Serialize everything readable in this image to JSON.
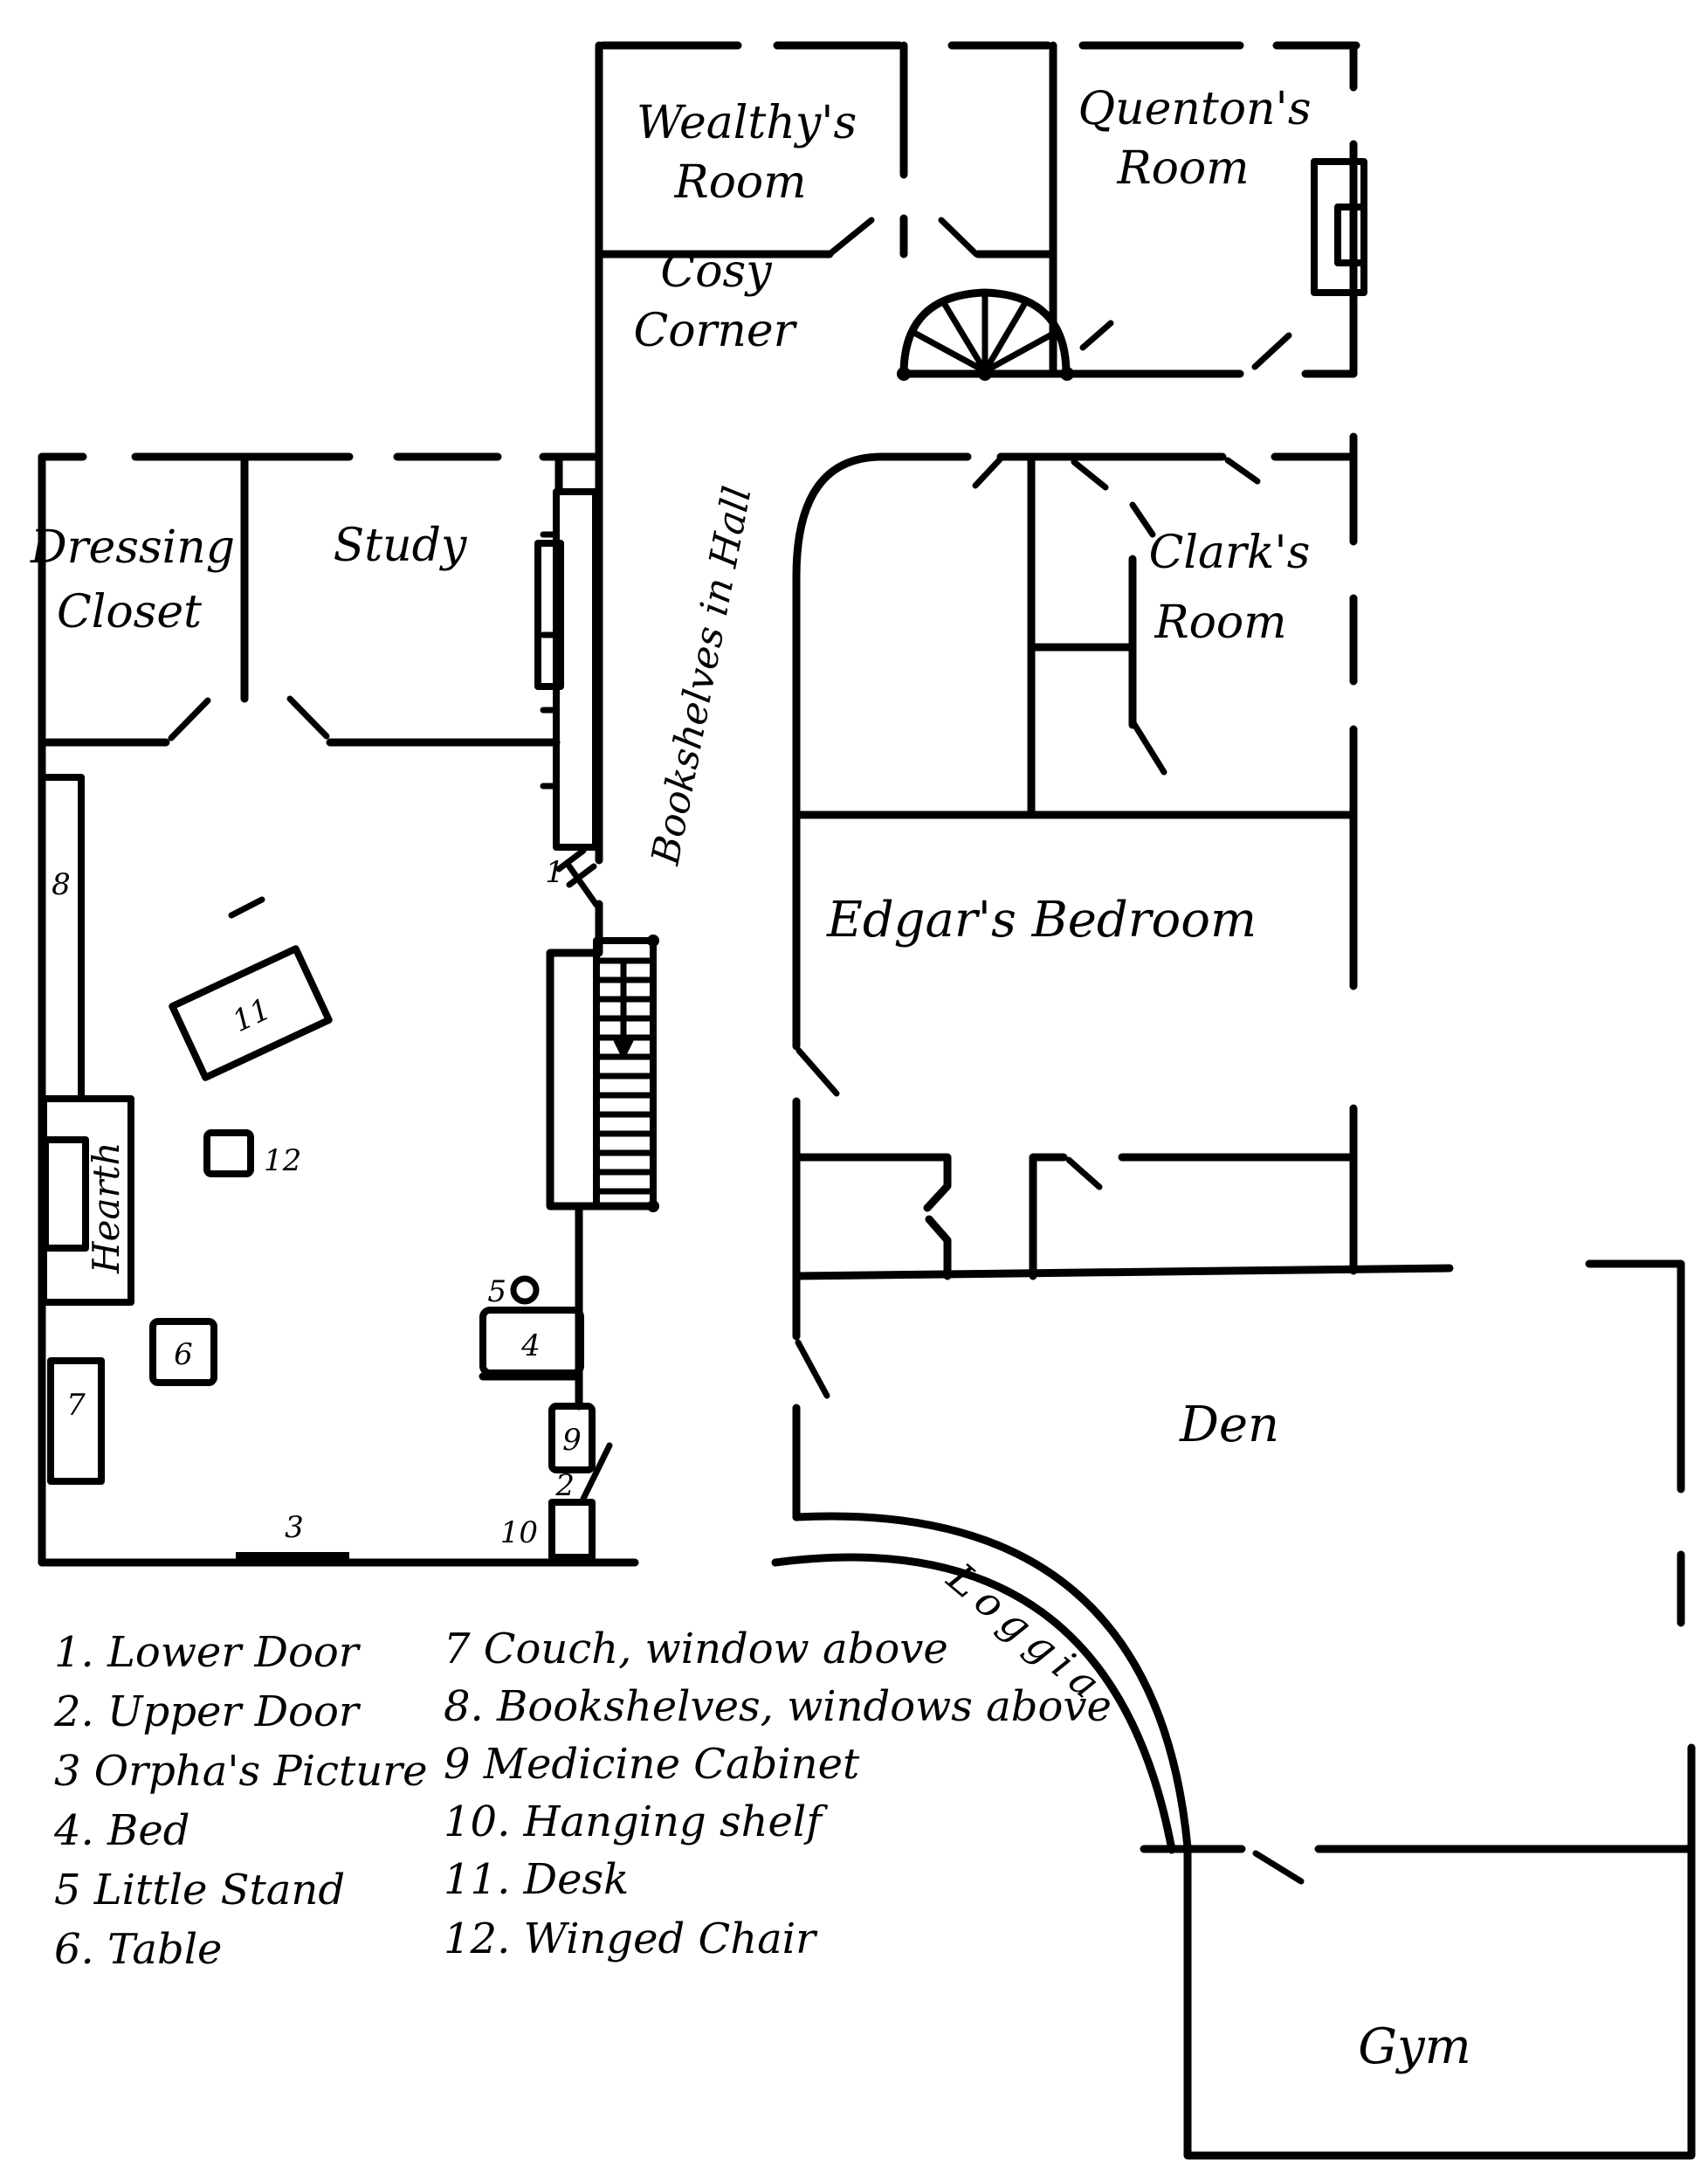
{
  "canvas": {
    "background": "#ffffff",
    "ink": "#000000"
  },
  "rooms": {
    "wealthy": {
      "line1": "Wealthy's",
      "line2": "Room"
    },
    "quenton": {
      "line1": "Quenton's",
      "line2": "Room"
    },
    "cosy": {
      "line1": "Cosy",
      "line2": "Corner"
    },
    "dressing": {
      "line1": "Dressing",
      "line2": "Closet"
    },
    "study": {
      "label": "Study"
    },
    "clark": {
      "line1": "Clark's",
      "line2": "Room"
    },
    "edgar": {
      "label": "Edgar's Bedroom"
    },
    "den": {
      "label": "Den"
    },
    "loggia": {
      "label": "Loggia"
    },
    "gym": {
      "label": "Gym"
    },
    "hall_bookshelves": {
      "label": "Bookshelves in Hall"
    },
    "hearth": {
      "label": "Hearth"
    }
  },
  "markers": {
    "m1": "1",
    "m2": "2",
    "m3": "3",
    "m4": "4",
    "m5": "5",
    "m6": "6",
    "m7": "7",
    "m8": "8",
    "m9": "9",
    "m10": "10",
    "m11": "11",
    "m12": "12"
  },
  "legend": {
    "items": [
      "1. Lower Door",
      "2. Upper Door",
      "3  Orpha's Picture",
      "4. Bed",
      "5  Little Stand",
      "6. Table",
      "7  Couch, window above",
      "8. Bookshelves, windows above",
      "9  Medicine Cabinet",
      "10. Hanging shelf",
      "11. Desk",
      "12. Winged Chair"
    ]
  }
}
